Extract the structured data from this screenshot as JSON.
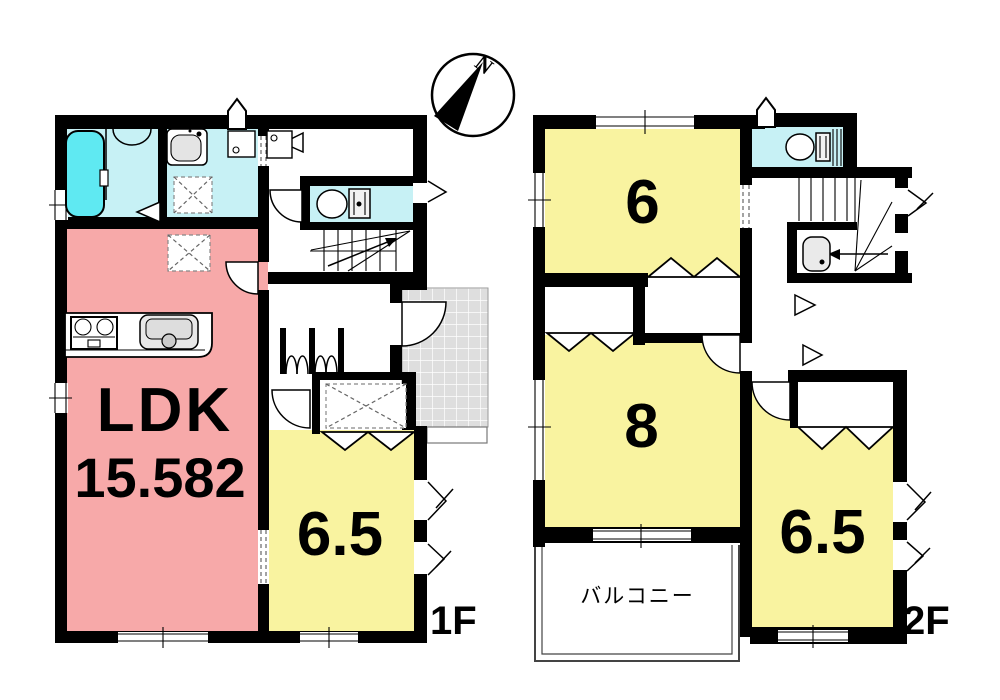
{
  "compass": {
    "label": "N"
  },
  "floor1": {
    "floor_label": "1F",
    "ldk_name": "LDK",
    "ldk_area": "15.582",
    "room_label": "6.5"
  },
  "floor2": {
    "floor_label": "2F",
    "room6_label": "6",
    "room8_label": "8",
    "room65_label": "6.5",
    "balcony_label": "バルコニー"
  },
  "colors": {
    "ldk_pink": "#F7A9A9",
    "room_yellow": "#F9F3A0",
    "wet_cyan": "#C7F1F5",
    "bathtub_cyan": "#5FE9F2",
    "porch_tile_gray": "#DEDEDE",
    "wall_black": "#000000"
  },
  "icons": {
    "compass": "compass-north-icon",
    "bathtub": "bathtub-icon",
    "sink": "washbasin-icon",
    "toilet": "toilet-icon",
    "stove": "kitchen-stove-icon",
    "kitchen_sink": "kitchen-sink-icon",
    "stairs": "stairs-icon"
  }
}
